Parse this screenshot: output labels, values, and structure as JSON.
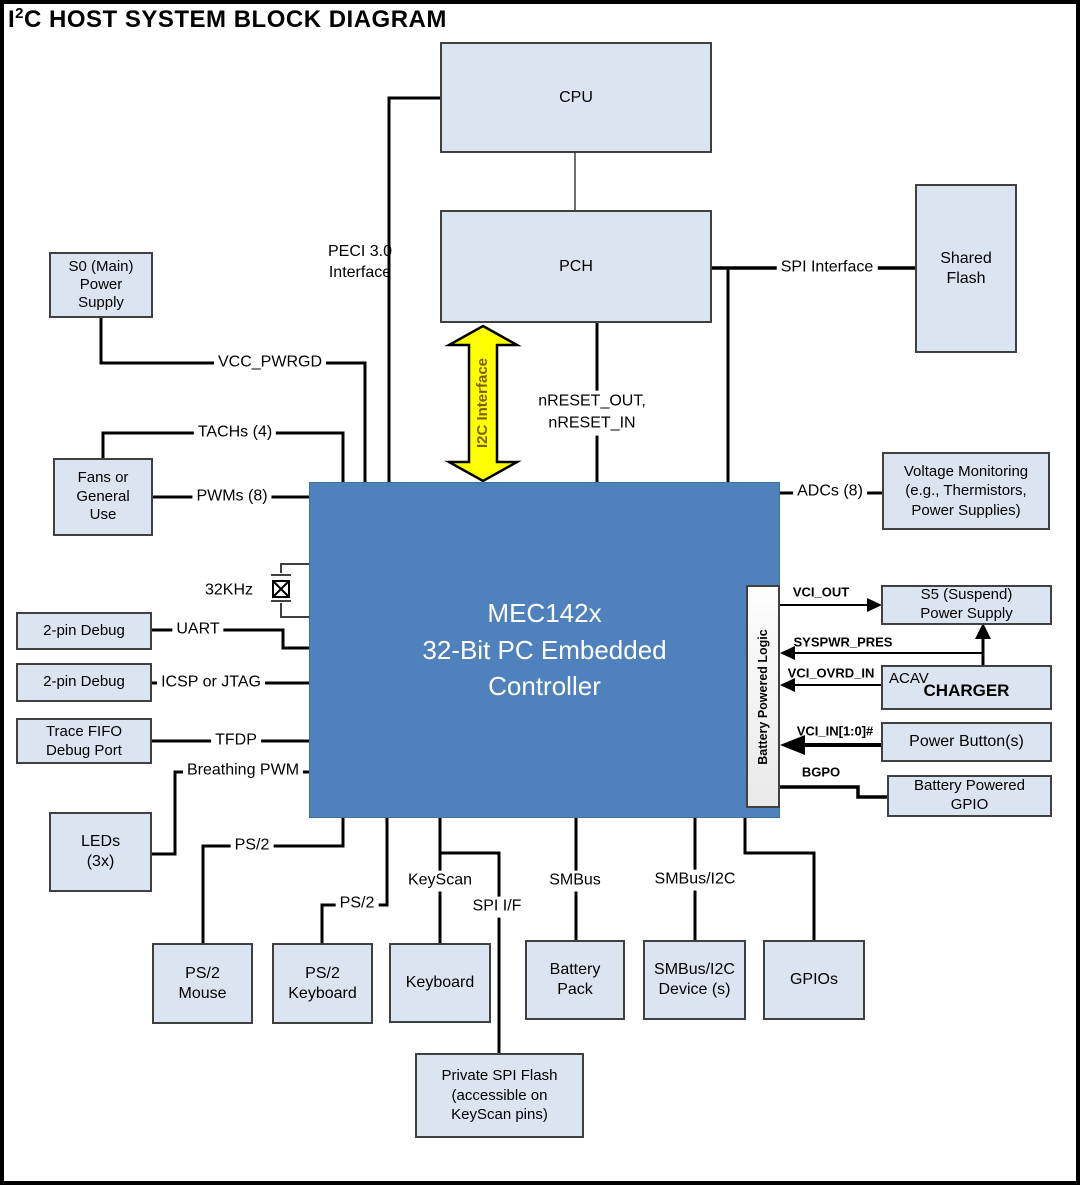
{
  "title": {
    "prefix": "I",
    "sup": "2",
    "rest": "C HOST SYSTEM BLOCK DIAGRAM"
  },
  "blocks": {
    "cpu": "CPU",
    "pch": "PCH",
    "shared_flash": "Shared\nFlash",
    "s0_power": "S0 (Main)\nPower\nSupply",
    "fans": "Fans or\nGeneral\nUse",
    "debug_uart": "2-pin Debug",
    "debug_icsp": "2-pin Debug",
    "trace_fifo": "Trace FIFO\nDebug Port",
    "leds": "LEDs\n(3x)",
    "controller": "MEC142x\n32-Bit PC Embedded\nController",
    "battery_logic": "Battery Powered Logic",
    "voltage_monitoring": "Voltage Monitoring\n(e.g., Thermistors,\nPower Supplies)",
    "s5_power": "S5 (Suspend)\nPower Supply",
    "charger_prefix": "ACAV",
    "charger": "CHARGER",
    "power_buttons": "Power Button(s)",
    "battery_gpio": "Battery Powered\nGPIO",
    "ps2_mouse": "PS/2\nMouse",
    "ps2_keyboard": "PS/2\nKeyboard",
    "keyboard": "Keyboard",
    "battery_pack": "Battery\nPack",
    "smbus_device": "SMBus/I2C\nDevice (s)",
    "gpios": "GPIOs",
    "private_flash": "Private SPI Flash\n(accessible on\nKeyScan pins)"
  },
  "labels": {
    "peci": "PECI 3.0\nInterface",
    "spi_interface": "SPI Interface",
    "i2c_interface": "I2C Interface",
    "nreset": "nRESET_OUT,\nnRESET_IN",
    "vcc_pwrgd": "VCC_PWRGD",
    "tachs": "TACHs (4)",
    "pwms": "PWMs (8)",
    "khz32": "32KHz",
    "uart": "UART",
    "icsp": "ICSP or JTAG",
    "tfdp": "TFDP",
    "breathing": "Breathing PWM",
    "ps2_a": "PS/2",
    "ps2_b": "PS/2",
    "keyscan": "KeyScan",
    "spi_if": "SPI I/F",
    "smbus": "SMBus",
    "smbus_i2c": "SMBus/I2C",
    "adcs": "ADCs (8)",
    "vci_out": "VCI_OUT",
    "syspwr_pres": "SYSPWR_PRES",
    "vci_ovrd_in": "VCI_OVRD_IN",
    "vci_in": "VCI_IN[1:0]#",
    "bgpo": "BGPO"
  },
  "colors": {
    "block_fill": "#dbe5f1",
    "block_border": "#404040",
    "controller_fill": "#4f81bd",
    "controller_text": "#ffffff",
    "i2c_arrow_fill": "#ffff00",
    "i2c_arrow_text": "#7f6000",
    "wire": "#000000"
  }
}
